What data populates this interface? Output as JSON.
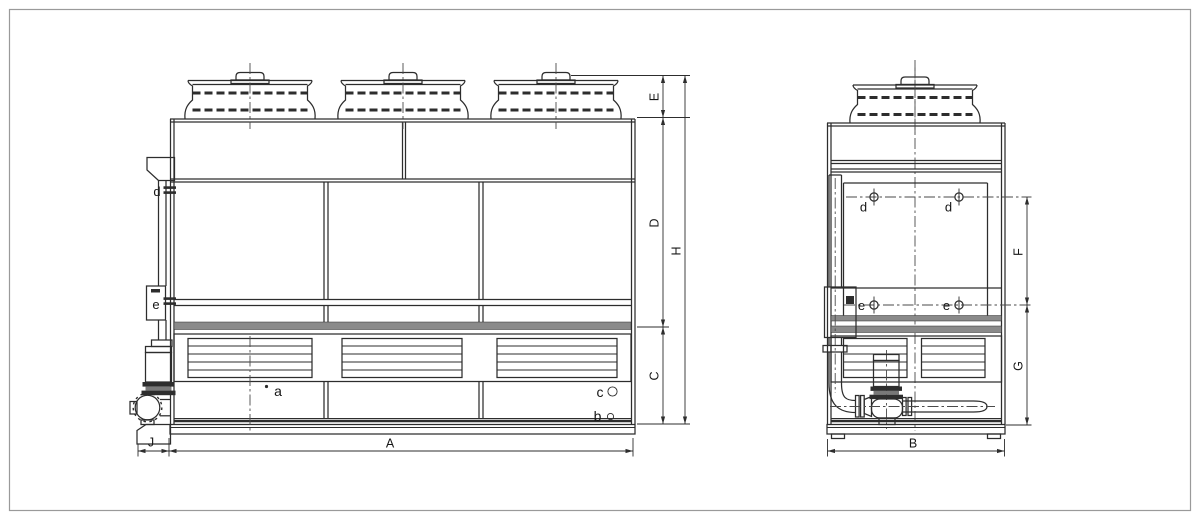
{
  "colors": {
    "line": "#2d2d2d",
    "centerline": "#4a4a4a",
    "band_fill": "#8a8a8a",
    "page_border": "#9a9a9a",
    "background": "#ffffff"
  },
  "front_view": {
    "dims": {
      "A": "A",
      "C": "C",
      "D": "D",
      "E": "E",
      "H": "H",
      "J": "J"
    },
    "ports": {
      "a": "a",
      "b": "b",
      "c": "c",
      "d": "d",
      "e": "e"
    }
  },
  "side_view": {
    "dims": {
      "B": "B",
      "F": "F",
      "G": "G"
    },
    "ports": {
      "d_left": "d",
      "d_right": "d",
      "e_left": "e",
      "e_right": "e"
    }
  }
}
